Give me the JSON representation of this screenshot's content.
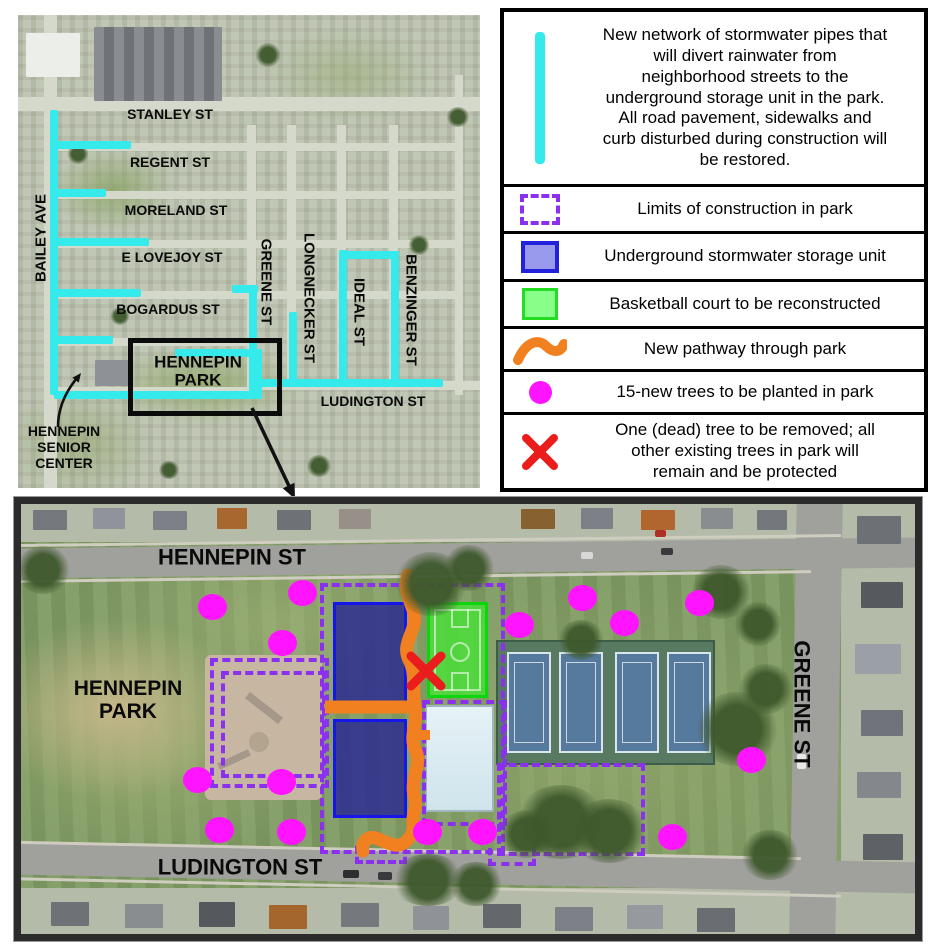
{
  "overview": {
    "streets": [
      {
        "label": "STANLEY ST"
      },
      {
        "label": "REGENT ST"
      },
      {
        "label": "MORELAND ST"
      },
      {
        "label": "E LOVEJOY ST"
      },
      {
        "label": "BOGARDUS ST"
      },
      {
        "label": "BAILEY AVE"
      },
      {
        "label": "GREENE ST"
      },
      {
        "label": "LONGNECKER ST"
      },
      {
        "label": "IDEAL ST"
      },
      {
        "label": "BENZINGER ST"
      },
      {
        "label": "LUDINGTON ST"
      }
    ],
    "park": [
      "HENNEPIN",
      "PARK"
    ],
    "senior_center": [
      "HENNEPIN",
      "SENIOR",
      "CENTER"
    ]
  },
  "legend": {
    "items": [
      {
        "symbol": "stormwater-pipe",
        "text": "New network of stormwater pipes that will divert rainwater from neighborhood streets to the underground storage unit in the park. All road pavement, sidewalks and curb disturbed during construction will be restored."
      },
      {
        "symbol": "construction-limits",
        "text": "Limits of construction in park"
      },
      {
        "symbol": "storage-unit",
        "text": "Underground stormwater storage unit"
      },
      {
        "symbol": "basketball-court",
        "text": "Basketball court to be reconstructed"
      },
      {
        "symbol": "new-pathway",
        "text": "New pathway through park"
      },
      {
        "symbol": "new-tree",
        "text": "15-new trees to be planted in park"
      },
      {
        "symbol": "tree-removal",
        "text": "One (dead) tree to be removed; all other existing trees in park will remain and be protected"
      }
    ]
  },
  "detail": {
    "street_labels": {
      "hennepin": "HENNEPIN ST",
      "ludington": "LUDINGTON ST",
      "greene": "GREENE ST"
    },
    "park": [
      "HENNEPIN",
      "PARK"
    ],
    "new_tree_count": 15
  },
  "colors": {
    "pipe_cyan": "#35EAEA",
    "construction_purple": "#8B30EE",
    "storage_fill_legend": "#9999EE",
    "storage_border": "#2222DD",
    "storage_fill_map": "#2B2B90",
    "court_fill_legend": "#88FF88",
    "court_border": "#22DD22",
    "pathway_orange": "#F08020",
    "tree_magenta": "#FF14FF",
    "removal_red": "#EA1C1C"
  }
}
